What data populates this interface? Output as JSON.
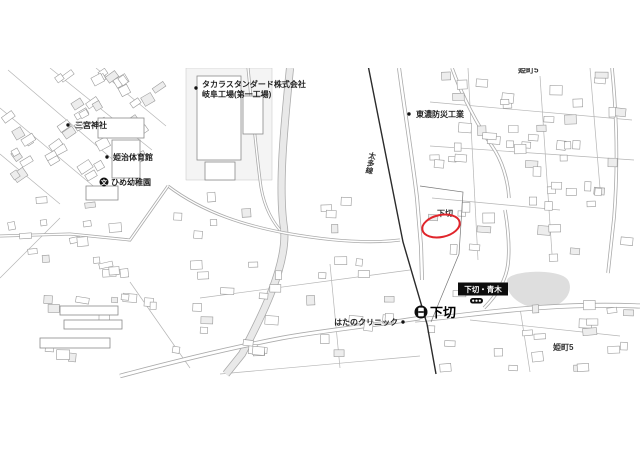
{
  "map": {
    "labels": {
      "factory_line1": "タカラスタンダード株式会社",
      "factory_line2": "岐阜工場(第一工場)",
      "shrine": "三宮神社",
      "gym": "姫治体育館",
      "kindergarten": "ひめ幼稚園",
      "school_symbol": "文",
      "disaster_company": "東濃防災工業",
      "railway": "太多線",
      "district_shimogiri": "下切",
      "station": "下切",
      "clinic": "はたのクリニック",
      "intersection_sign": "下切・青木",
      "district_himecho5": "姫町5",
      "district_top_clipped": "姫町5"
    },
    "annotation": {
      "shape": "ellipse",
      "color": "#e0252b"
    },
    "colors": {
      "railway_line": "#2b2b2b",
      "road_casing": "#ababab",
      "building_outline": "#9a9a9a",
      "water_fill": "#dedede",
      "label_dark": "#222222"
    }
  }
}
